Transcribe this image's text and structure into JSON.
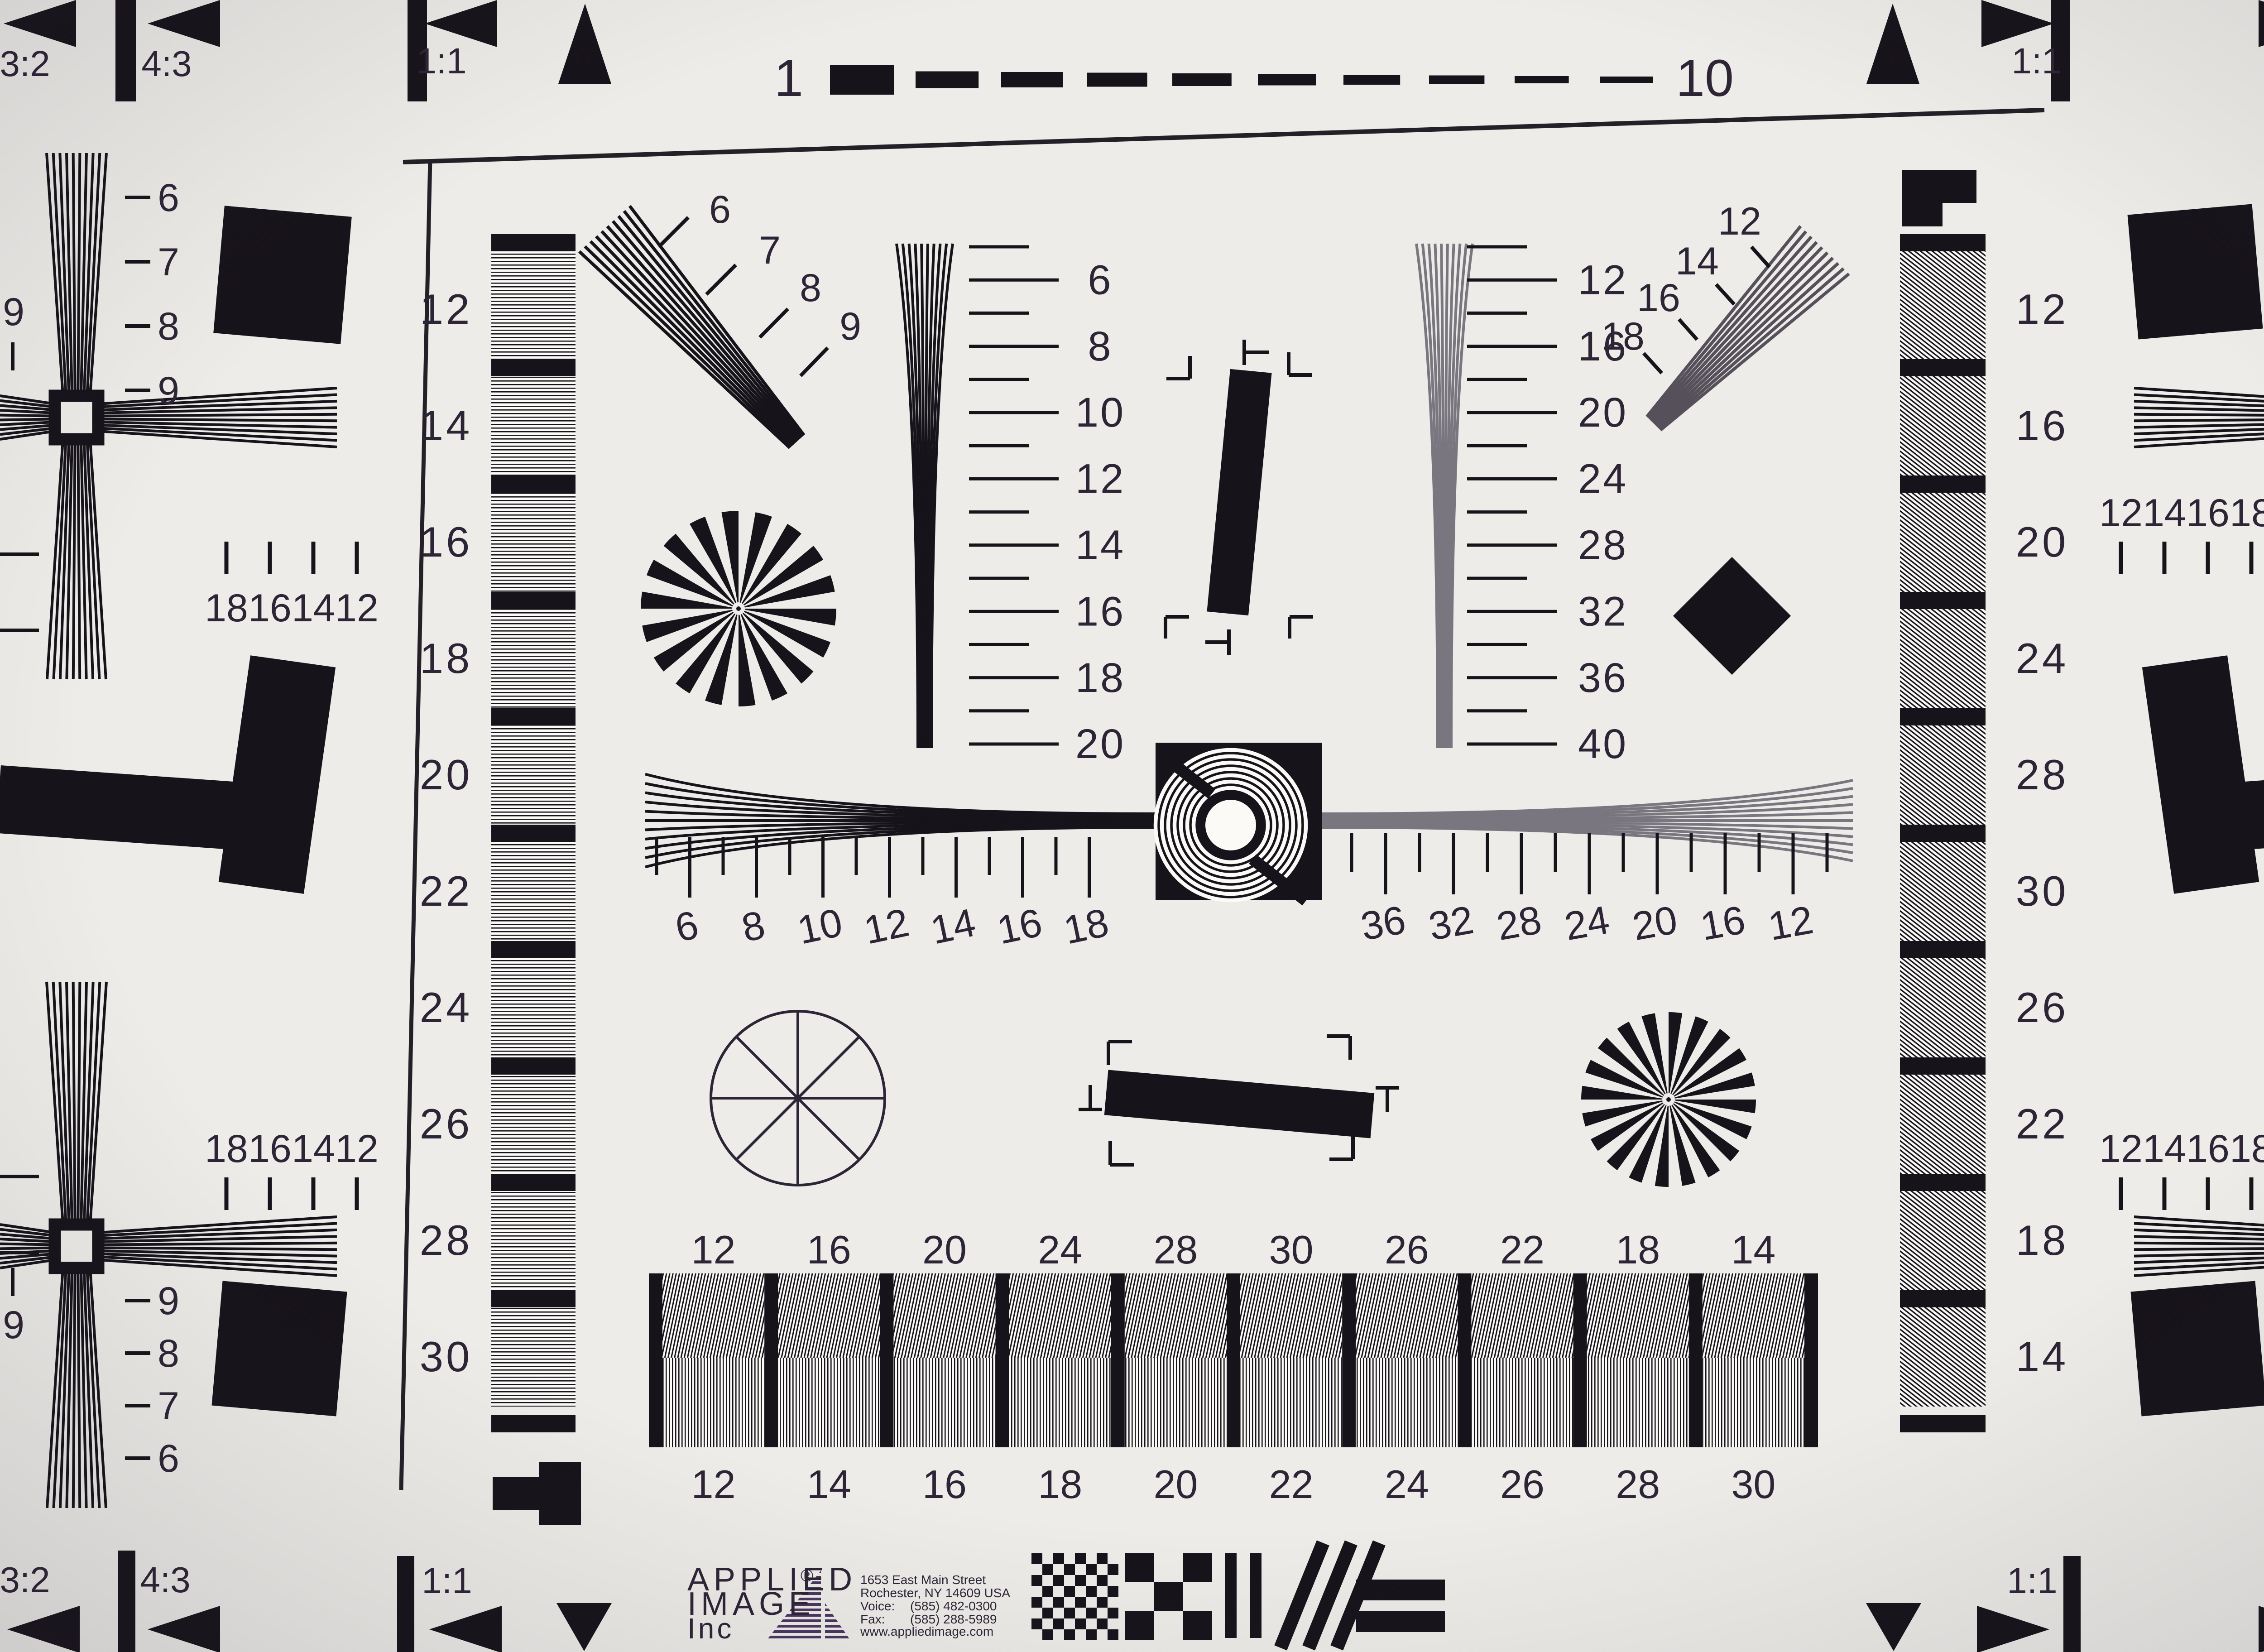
{
  "chart_title": "ISO resolution test chart",
  "top_scale": {
    "start": "1",
    "end": "10"
  },
  "corners": {
    "top_left": [
      "3:2",
      "4:3",
      "1:1"
    ],
    "top_right": [
      "1:1",
      "4:3",
      "3:2"
    ],
    "bottom_left": [
      "3:2",
      "4:3",
      "1:1"
    ],
    "bottom_right": [
      "1:1",
      "4:3",
      "3:2"
    ]
  },
  "left_column_labels": [
    "12",
    "14",
    "16",
    "18",
    "20",
    "22",
    "24",
    "26",
    "28",
    "30"
  ],
  "right_column_labels": [
    "12",
    "16",
    "20",
    "24",
    "28",
    "30",
    "26",
    "22",
    "18",
    "14"
  ],
  "wedge_left_scale": [
    "6",
    "8",
    "10",
    "12",
    "14",
    "16",
    "18",
    "20"
  ],
  "wedge_right_scale": [
    "12",
    "16",
    "20",
    "24",
    "28",
    "32",
    "36",
    "40"
  ],
  "h_scale_left": [
    "6",
    "8",
    "10",
    "12",
    "14",
    "16",
    "18"
  ],
  "h_scale_right": [
    "36",
    "32",
    "28",
    "24",
    "20",
    "16",
    "12"
  ],
  "diag_left_scale": [
    "6",
    "7",
    "8",
    "9"
  ],
  "diag_right_scale": [
    "12",
    "14",
    "16",
    "18"
  ],
  "bottom_bar_top_labels": [
    "12",
    "16",
    "20",
    "24",
    "28",
    "30",
    "26",
    "22",
    "18",
    "14"
  ],
  "bottom_bar_bottom_labels": [
    "12",
    "14",
    "16",
    "18",
    "20",
    "22",
    "24",
    "26",
    "28",
    "30"
  ],
  "cross_tick_labels_left": [
    "18",
    "16",
    "14",
    "12"
  ],
  "cross_tick_labels_right": [
    "12",
    "14",
    "16",
    "18"
  ],
  "edge_scale_top": [
    "6",
    "7",
    "8",
    "9"
  ],
  "edge_scale_bottom": [
    "9",
    "8",
    "7",
    "6"
  ],
  "edge_corner_digit": "9",
  "logo": {
    "line1": "APPLIED",
    "reg": "®",
    "line2": "IMAGE",
    "line3": "Inc",
    "address1": "1653 East Main Street",
    "address2": "Rochester, NY  14609  USA",
    "voice_label": "Voice:",
    "voice_number": "(585) 482-0300",
    "fax_label": "Fax:",
    "fax_number": "(585) 288-5989",
    "website": "www.appliedimage.com"
  },
  "colors": {
    "background": "#edece8",
    "ink": "#17131a",
    "label": "#2d2436",
    "gray_line": "#55505a",
    "soft_line": "#7a767f",
    "logo_purple": "#4a3760",
    "address_purple": "#544368",
    "paper_light": "#fbfaf7"
  }
}
